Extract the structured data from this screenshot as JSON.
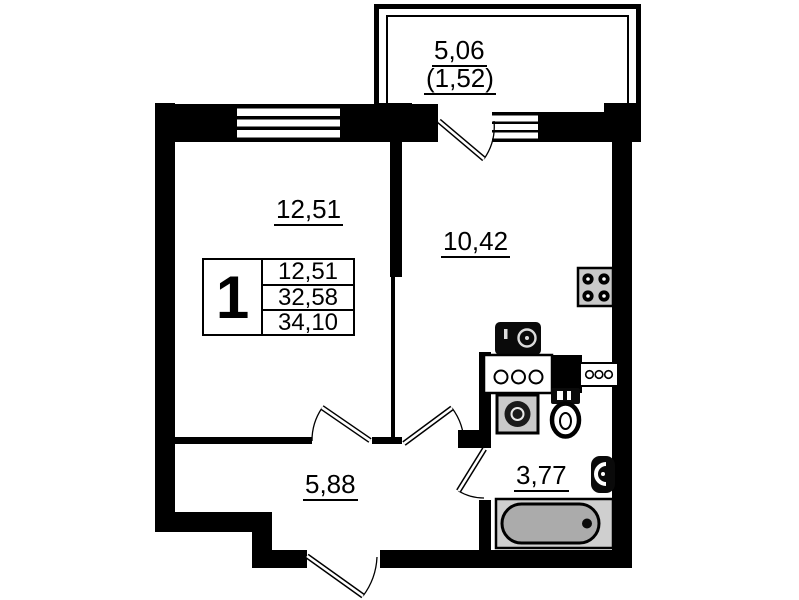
{
  "rooms": {
    "balcony": {
      "area": "5,06",
      "secondary": "(1,52)"
    },
    "living": {
      "area": "12,51"
    },
    "kitchen": {
      "area": "10,42"
    },
    "hallway": {
      "area": "5,88"
    },
    "bathroom": {
      "area": "3,77"
    }
  },
  "info_table": {
    "room_count": "1",
    "rows": [
      "12,51",
      "32,58",
      "34,10"
    ]
  },
  "colors": {
    "wall": "#000000",
    "bathtub_inner": "#ababab",
    "fixture_gray": "#c9c9c9"
  }
}
